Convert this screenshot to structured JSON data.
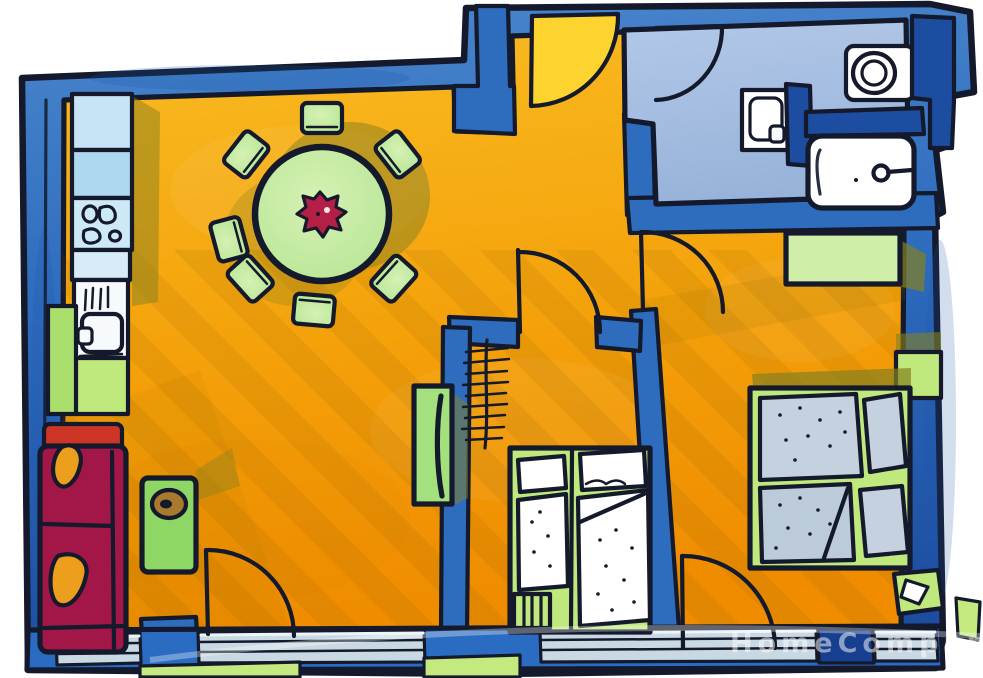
{
  "watermark": {
    "text": "HomeCompan"
  },
  "palette": {
    "ink": "#141a2c",
    "wall_blue": "#2e6cbe",
    "wall_blue_light": "#4a86cc",
    "wall_dark": "#1c4da0",
    "floor_orange_light": "#f9bb22",
    "floor_orange": "#f4a10a",
    "floor_orange_deep": "#ef8c00",
    "entry_yellow": "#fdd42f",
    "bath_floor_light": "#b3c8e8",
    "bath_floor": "#97b3da",
    "counter_blue": "#aed8f0",
    "counter_blue_light": "#c6e4f5",
    "appliance_white": "#f7fafc",
    "table_green": "#b5e593",
    "kids_green": "#bfe97d",
    "pale_green": "#cfeea8",
    "side_green": "#a5e07f",
    "fridge_green": "#aade6d",
    "coffee_green": "#8fd765",
    "sofa_red": "#a31648",
    "sofa_red_top": "#cd3526",
    "cushion_amber": "#eb9f1d",
    "flower_red": "#b31f45",
    "bowl_brown": "#a87a2e",
    "olive_shadow": "#85801f",
    "mattress_gray": "#c5d1df",
    "mattress_gray_dark": "#bccbd9",
    "balcony_plank": "#c9d9e3",
    "balcony_post": "#2a6cc2",
    "balcony_post_dark": "#173f8f",
    "grass_green": "#c4e97e",
    "watermark_white": "rgba(255,255,255,0.5)"
  }
}
